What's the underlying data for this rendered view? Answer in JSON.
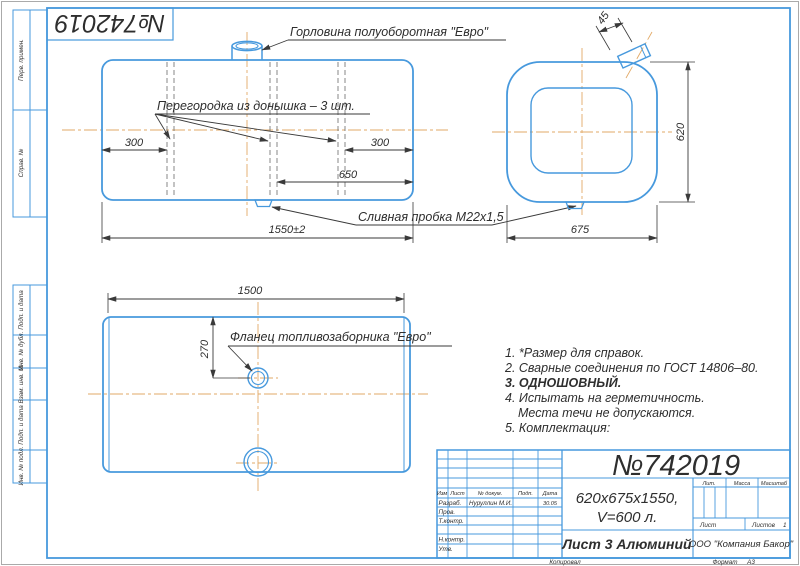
{
  "colors": {
    "line_blue": "#4799dd",
    "centerline_orange": "#e2aa67",
    "ink": "#3a3a3a",
    "paper": "#ffffff"
  },
  "stamp": {
    "number": "№742019"
  },
  "margin_labels": {
    "top": [
      {
        "label": "Перв. примен."
      },
      {
        "label": "Справ. №"
      }
    ],
    "bottom": [
      {
        "label": "Подп. и дата"
      },
      {
        "label": "Инв. № дубл."
      },
      {
        "label": "Взам. инв. №"
      },
      {
        "label": "Подп. и дата"
      },
      {
        "label": "Инв. № подл."
      }
    ]
  },
  "side_view": {
    "neck_label": "Горловина полуоборотная \"Евро\"",
    "baffle_label": "Перегородка из донышка – 3 шт.",
    "drain_label": "Сливная пробка М22х1,5",
    "dim_left": "300",
    "dim_right": "300",
    "dim_mid": "650",
    "dim_total": "1550±2"
  },
  "end_view": {
    "dim_angle": "45",
    "dim_height": "620",
    "dim_width": "675"
  },
  "bottom_view": {
    "flange_label": "Фланец топливозаборника \"Евро\"",
    "dim_length": "1500",
    "dim_offset": "270"
  },
  "notes": {
    "lines": [
      "1. *Размер для справок.",
      "2. Сварные соединения по ГОСТ 14806–80.",
      "3. ОДНОШОВНЫЙ.",
      "4. Испытать на герметичность.",
      "Места течи не допускаются.",
      "5. Комплектация:"
    ]
  },
  "title_block": {
    "big_number": "№742019",
    "size_line1": "620х675х1550,",
    "size_line2": "V=600 л.",
    "material": "Лист 3 Алюминий",
    "company": "ООО \"Компания Бакор\"",
    "rev_headers": {
      "izm": "Изм",
      "list": "Лист",
      "doc": "№ докум.",
      "podp": "Подп.",
      "data": "Дата"
    },
    "rows": {
      "razrab": "Разраб.",
      "prov": "Пров.",
      "tkontr": "Т.контр.",
      "nkontr": "Н.контр.",
      "utv": "Утв."
    },
    "razrab_name": "Нуруллин М.И.",
    "razrab_date": "30.05",
    "lit_label": "Лит.",
    "massa_label": "Масса",
    "masshtab_label": "Масштаб",
    "list_label": "Лист",
    "listov_label": "Листов",
    "listov_value": "1",
    "kopiroval": "Копировал",
    "format_label": "Формат",
    "format_value": "А3"
  }
}
